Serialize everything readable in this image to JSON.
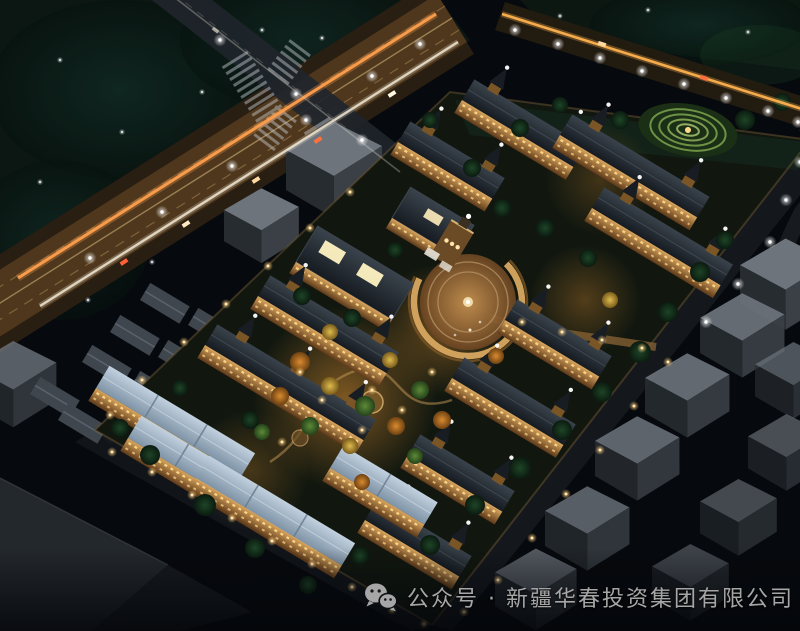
{
  "scene": {
    "type": "aerial-night-rendering",
    "subject": "residential community master plan, bird's-eye night view with lit boulevards, central garden and entrance plaza"
  },
  "caption": {
    "icon": "wechat-icon",
    "text": "公众号 · 新疆华春投资集团有限公司"
  },
  "colors": {
    "background": "#06090d",
    "forest_teal": "#0c1713",
    "road_base": "#291e12",
    "road_glow": "#6e4d24",
    "trail_orange": "#ff9f4d",
    "trail_white": "#f2e8d4",
    "window_light": "#ffd98a",
    "facade_warm": "#d8a55e",
    "roof_blue": "#a9bccd",
    "roof_dark": "#232b33",
    "context_gray": "#6d747c",
    "tree_dark": "#15351f",
    "autumn_orange": "#d98a2f",
    "autumn_yellow": "#debb4e",
    "lawn_green": "#7ea34e",
    "plaza_warm": "#c08a4a",
    "lamp_white": "#ffffff",
    "perimeter_lamp": "#ffce7d",
    "caption_text": "#a6a6a6"
  }
}
